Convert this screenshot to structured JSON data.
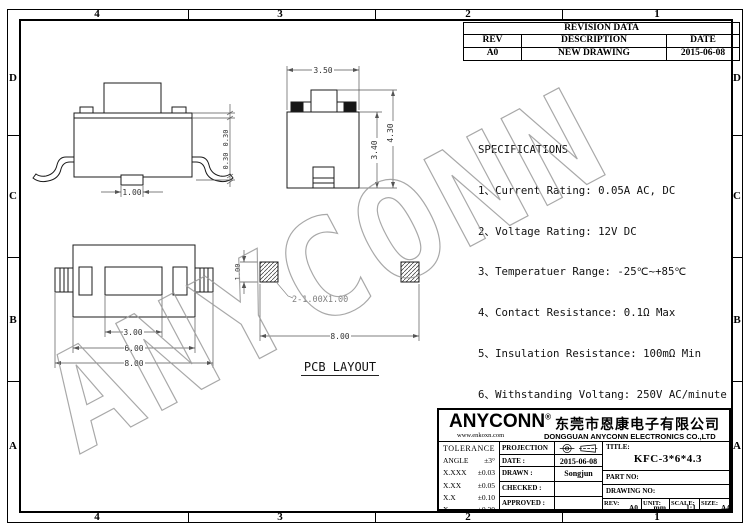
{
  "watermark": "ANYCONN",
  "border": {
    "columns": [
      "4",
      "3",
      "2",
      "1"
    ],
    "rows_letters": [
      "D",
      "C",
      "B",
      "A"
    ]
  },
  "revision_table": {
    "title": "REVISION DATA",
    "headers": [
      "REV",
      "DESCRIPTION",
      "DATE"
    ],
    "row": [
      "A0",
      "NEW DRAWING",
      "2015-06-08"
    ]
  },
  "specifications": {
    "title": "SPECIFICATIONS",
    "items": [
      "1、Current Rating: 0.05A AC, DC",
      "2、Voltage Rating: 12V DC",
      "3、Temperatuer Range: -25℃~+85℃",
      "4、Contact Resistance: 0.1Ω Max",
      "5、Insulation Resistance: 100mΩ Min",
      "6、Withstanding Voltang: 250V AC/minute"
    ]
  },
  "dimensions": {
    "side_view": {
      "lead_pitch": "1.00",
      "dim_top": "0.30",
      "dim_bottom": "0.30"
    },
    "front_view": {
      "top_width": "3.50",
      "body_height": "3.40",
      "total_height": "4.30"
    },
    "top_view": {
      "button_width": "3.00",
      "body_width": "6.00",
      "overall_width": "8.00"
    },
    "pcb": {
      "pad_height": "1.00",
      "pad_note": "2-1.00X1.00",
      "pad_span": "8.00",
      "caption": "PCB LAYOUT"
    }
  },
  "title_block": {
    "brand": "ANYCONN",
    "brand_reg": "®",
    "company_cn": "东莞市恩康电子有限公司",
    "website": "www.enkoxn.com",
    "company_en": "DONGGUAN ANYCONN ELECTRONICS CO.,LTD",
    "tolerance": {
      "title": "TOLERANCE",
      "rows": [
        {
          "label": "ANGLE",
          "value": "±3°"
        },
        {
          "label": "X.XXX",
          "value": "±0.03"
        },
        {
          "label": "X.XX",
          "value": "±0.05"
        },
        {
          "label": "X.X",
          "value": "±0.10"
        },
        {
          "label": "X.",
          "value": "±0.20"
        }
      ]
    },
    "fields": {
      "projection_label": "PROJECTION",
      "date_label": "DATE :",
      "date_value": "2015-06-08",
      "drawn_label": "DRAWN :",
      "drawn_value": "Songjun",
      "checked_label": "CHECKED :",
      "checked_value": "",
      "approved_label": "APPROVED :",
      "approved_value": "",
      "title_label": "TITLE:",
      "title_value": "KFC-3*6*4.3",
      "part_no_label": "PART NO:",
      "part_no_value": "",
      "drawing_no_label": "DRAWING NO:",
      "drawing_no_value": "",
      "rev_label": "REV:",
      "rev_value": "A0",
      "unit_label": "UNIT:",
      "unit_value": "mm",
      "scale_label": "SCALE:",
      "scale_value": "1:1",
      "size_label": "SIZE:",
      "size_value": "A4"
    }
  }
}
